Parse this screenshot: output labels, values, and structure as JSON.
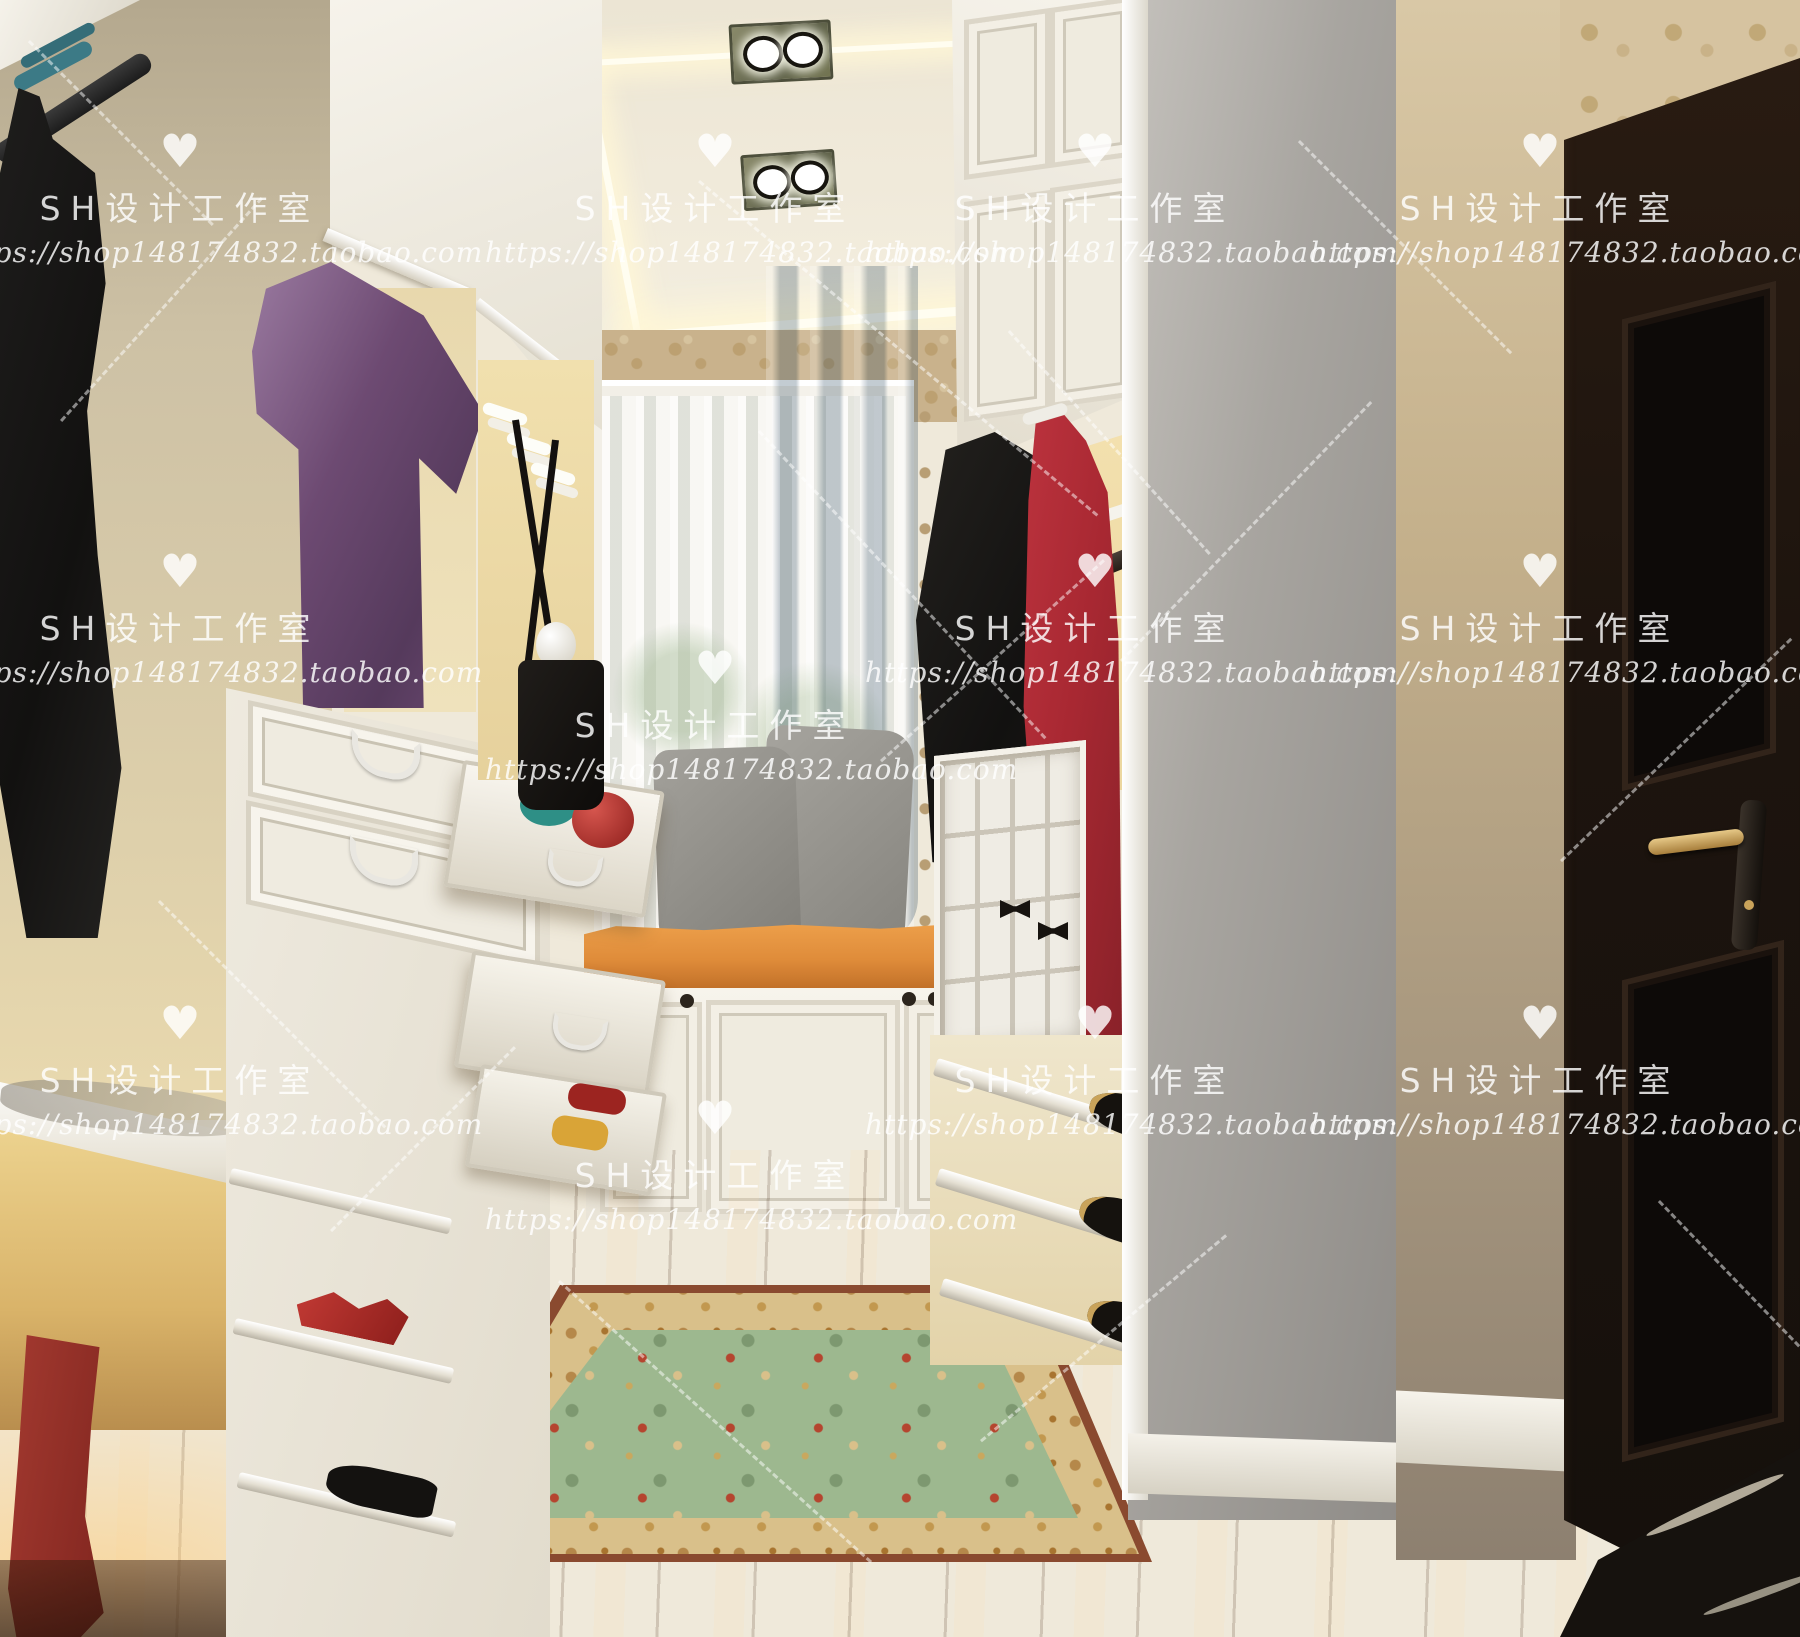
{
  "image": {
    "kind": "interior-3d-render-photo",
    "subject": "walk-in closet with white cabinetry, window seat and dark door"
  },
  "watermark": {
    "heart": "♥",
    "studio_label": "SH设计工作室",
    "url": "https://shop148174832.taobao.com",
    "text_color": "#ffffff"
  },
  "palette": {
    "ceiling_cream": "#efe9da",
    "cove_glow": "#fff7d6",
    "cabinet_white": "#f5f2ea",
    "lit_interior_gold": "#f0d9a0",
    "wallpaper_beige": "#c9b28c",
    "sheer_curtain": "#e9edef",
    "blue_curtain": "#7d98ad",
    "seat_cushion_orange": "#df8c3a",
    "pillow_gray": "#97958f",
    "black_garment": "#151413",
    "purple_garment": "#6d4a72",
    "red_dress": "#a82832",
    "rug_green": "#9db88f",
    "rug_border": "#d9c08a",
    "wood_floor": "#b07a45",
    "door_espresso": "#1d140e",
    "marble_dark": "#16120e",
    "boots_red": "#99322a"
  }
}
